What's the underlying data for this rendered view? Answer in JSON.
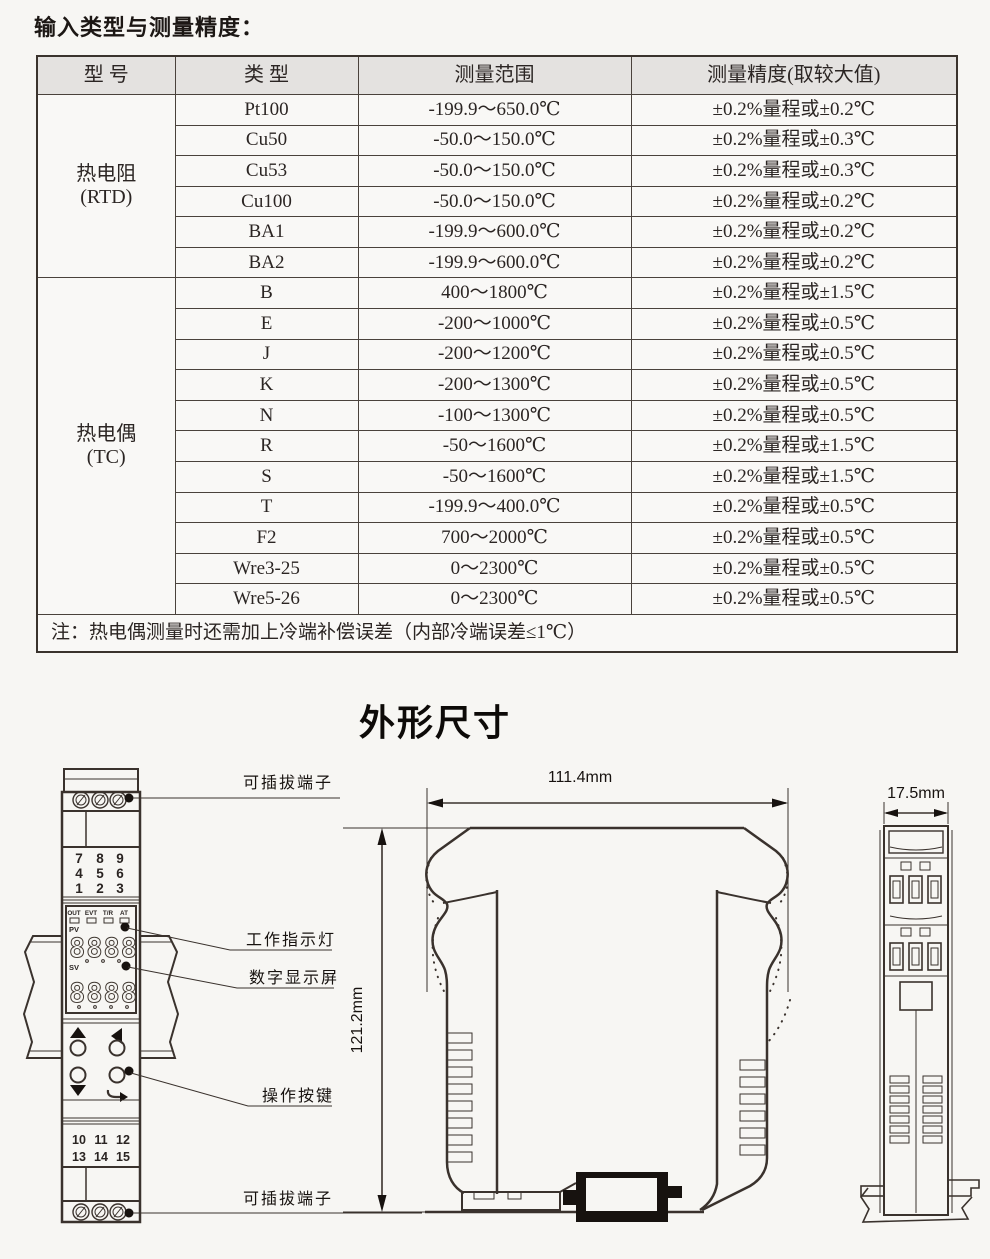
{
  "page": {
    "title": "输入类型与测量精度：",
    "section_title": "外形尺寸"
  },
  "table": {
    "headers": [
      "型  号",
      "类  型",
      "测量范围",
      "测量精度(取较大值)"
    ],
    "groups": [
      {
        "model": "热电阻",
        "model_code": "(RTD)",
        "rows": [
          {
            "type": "Pt100",
            "range": "-199.9～650.0℃",
            "acc": "±0.2%量程或±0.2℃"
          },
          {
            "type": "Cu50",
            "range": "-50.0～150.0℃",
            "acc": "±0.2%量程或±0.3℃"
          },
          {
            "type": "Cu53",
            "range": "-50.0～150.0℃",
            "acc": "±0.2%量程或±0.3℃"
          },
          {
            "type": "Cu100",
            "range": "-50.0～150.0℃",
            "acc": "±0.2%量程或±0.2℃"
          },
          {
            "type": "BA1",
            "range": "-199.9～600.0℃",
            "acc": "±0.2%量程或±0.2℃"
          },
          {
            "type": "BA2",
            "range": "-199.9～600.0℃",
            "acc": "±0.2%量程或±0.2℃"
          }
        ]
      },
      {
        "model": "热电偶",
        "model_code": "(TC)",
        "rows": [
          {
            "type": "B",
            "range": "400～1800℃",
            "acc": "±0.2%量程或±1.5℃"
          },
          {
            "type": "E",
            "range": "-200～1000℃",
            "acc": "±0.2%量程或±0.5℃"
          },
          {
            "type": "J",
            "range": "-200～1200℃",
            "acc": "±0.2%量程或±0.5℃"
          },
          {
            "type": "K",
            "range": "-200～1300℃",
            "acc": "±0.2%量程或±0.5℃"
          },
          {
            "type": "N",
            "range": "-100～1300℃",
            "acc": "±0.2%量程或±0.5℃"
          },
          {
            "type": "R",
            "range": "-50～1600℃",
            "acc": "±0.2%量程或±1.5℃"
          },
          {
            "type": "S",
            "range": "-50～1600℃",
            "acc": "±0.2%量程或±1.5℃"
          },
          {
            "type": "T",
            "range": "-199.9～400.0℃",
            "acc": "±0.2%量程或±0.5℃"
          },
          {
            "type": "F2",
            "range": "700～2000℃",
            "acc": "±0.2%量程或±0.5℃"
          },
          {
            "type": "Wre3-25",
            "range": "0～2300℃",
            "acc": "±0.2%量程或±0.5℃"
          },
          {
            "type": "Wre5-26",
            "range": "0～2300℃",
            "acc": "±0.2%量程或±0.5℃"
          }
        ]
      }
    ],
    "note": "注：热电偶测量时还需加上冷端补偿误差（内部冷端误差≤1℃）"
  },
  "drawing": {
    "labels": {
      "plug_terminal_top": "可插拔端子",
      "indicator": "工作指示灯",
      "display": "数字显示屏",
      "buttons": "操作按键",
      "plug_terminal_bottom": "可插拔端子"
    },
    "dims": {
      "width": "111.4mm",
      "height": "121.2mm",
      "depth": "17.5mm"
    },
    "front": {
      "r1": [
        "7",
        "8",
        "9"
      ],
      "r2": [
        "4",
        "5",
        "6"
      ],
      "r3": [
        "1",
        "2",
        "3"
      ],
      "b1": [
        "10",
        "11",
        "12"
      ],
      "b2": [
        "13",
        "14",
        "15"
      ],
      "leds": [
        "OUT",
        "EVT",
        "T/R",
        "AT"
      ],
      "pv": "PV",
      "sv": "SV",
      "digits": "8888"
    },
    "colors": {
      "red_terminal": "#c9302a",
      "line": "#3a322d"
    }
  }
}
